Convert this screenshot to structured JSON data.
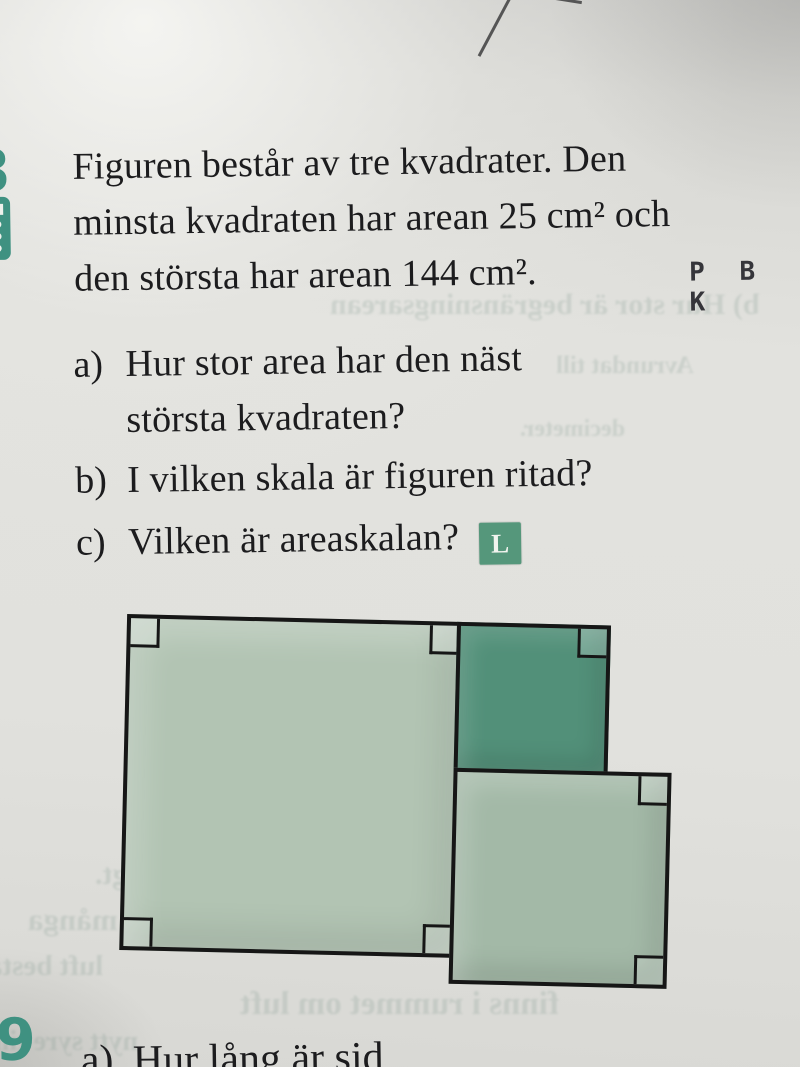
{
  "problem8": {
    "number": "8",
    "statement_lines": [
      "Figuren består av tre kvadrater. Den",
      "minsta kvadraten har arean 25 cm² och",
      "den största har arean 144 cm²."
    ],
    "ability_markers": [
      "P",
      "B",
      "K"
    ],
    "parts": [
      {
        "label": "a)",
        "lines": [
          "Hur stor area har den näst",
          "största kvadraten?"
        ]
      },
      {
        "label": "b)",
        "lines": [
          "I vilken skala är figuren ritad?"
        ]
      },
      {
        "label": "c)",
        "lines": [
          "Vilken är areaskalan?"
        ],
        "badge": "L"
      }
    ]
  },
  "problem9": {
    "number": "9",
    "part_label": "a)",
    "partial_text": "Hur lång är sid"
  },
  "figure": {
    "description": "Three squares: one large light-green square, a smaller dark-teal square at its top right, and a medium light-green square below the dark one, all with right-angle corner marks",
    "outline_color": "#161616",
    "squares": [
      {
        "name": "largest-square",
        "fill": "#b2c4b3",
        "corner_marks": [
          "top-left",
          "top-right",
          "bottom-left",
          "bottom-right"
        ]
      },
      {
        "name": "small-dark-square",
        "fill": "#529079",
        "corner_marks": [
          "top-right"
        ]
      },
      {
        "name": "medium-square",
        "fill": "#a3b9a7",
        "corner_marks": [
          "top-right",
          "bottom-right"
        ]
      }
    ]
  },
  "colors": {
    "accent_teal": "#3f9181",
    "badge_green": "#55977b",
    "page_background": "#e1e1dd",
    "text": "#1c1c1e"
  },
  "bleed_through": [
    {
      "text": "b) Hur stor är begränsningsarean",
      "x": 330,
      "y": 288,
      "size": 30
    },
    {
      "text": "Avrundat till",
      "x": 556,
      "y": 352,
      "size": 25
    },
    {
      "text": "decimeter.",
      "x": 520,
      "y": 416,
      "size": 24
    },
    {
      "text": "ängt.",
      "x": 95,
      "y": 858,
      "size": 30
    },
    {
      "text": "många",
      "x": 28,
      "y": 902,
      "size": 31
    },
    {
      "text": "luft bestå",
      "x": -12,
      "y": 950,
      "size": 29
    },
    {
      "text": "finns i rummet om luft",
      "x": 240,
      "y": 986,
      "size": 33
    },
    {
      "text": "nytt syre till",
      "x": -6,
      "y": 1026,
      "size": 28
    }
  ]
}
